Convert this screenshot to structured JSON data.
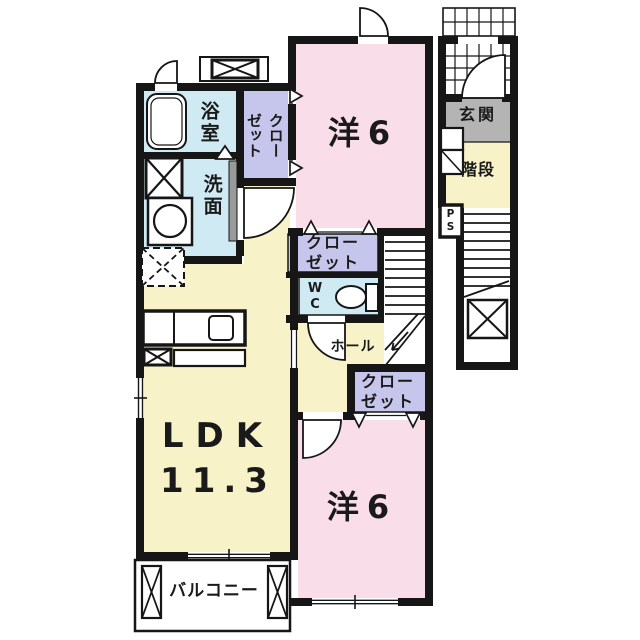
{
  "floor_plan": {
    "rooms": {
      "bath": {
        "label": "浴室"
      },
      "washroom": {
        "label": "洗面"
      },
      "closet_top": {
        "label": "クロー\nゼット"
      },
      "bedroom_top": {
        "label": "洋6"
      },
      "closet_middle": {
        "label": "クロー\nゼット"
      },
      "wc": {
        "label": "W\nC"
      },
      "hall": {
        "label": "ホール"
      },
      "closet_bottom": {
        "label": "クロー\nゼット"
      },
      "ldk": {
        "label": "LDK",
        "area": "11.3"
      },
      "bedroom_bottom": {
        "label": "洋6"
      },
      "balcony": {
        "label": "バルコニー"
      },
      "entrance": {
        "label": "玄関"
      },
      "staircase": {
        "label": "階段"
      },
      "pipe_space": {
        "label": "P\nS"
      }
    },
    "colors": {
      "wall": "#161616",
      "room_pink": "#f9dee9",
      "room_yellow": "#f7f2c8",
      "closet_lavender": "#c6c5eb",
      "water_blue": "#cfeaf2",
      "entrance_gray": "#b4b4b4",
      "background": "#ffffff"
    }
  }
}
